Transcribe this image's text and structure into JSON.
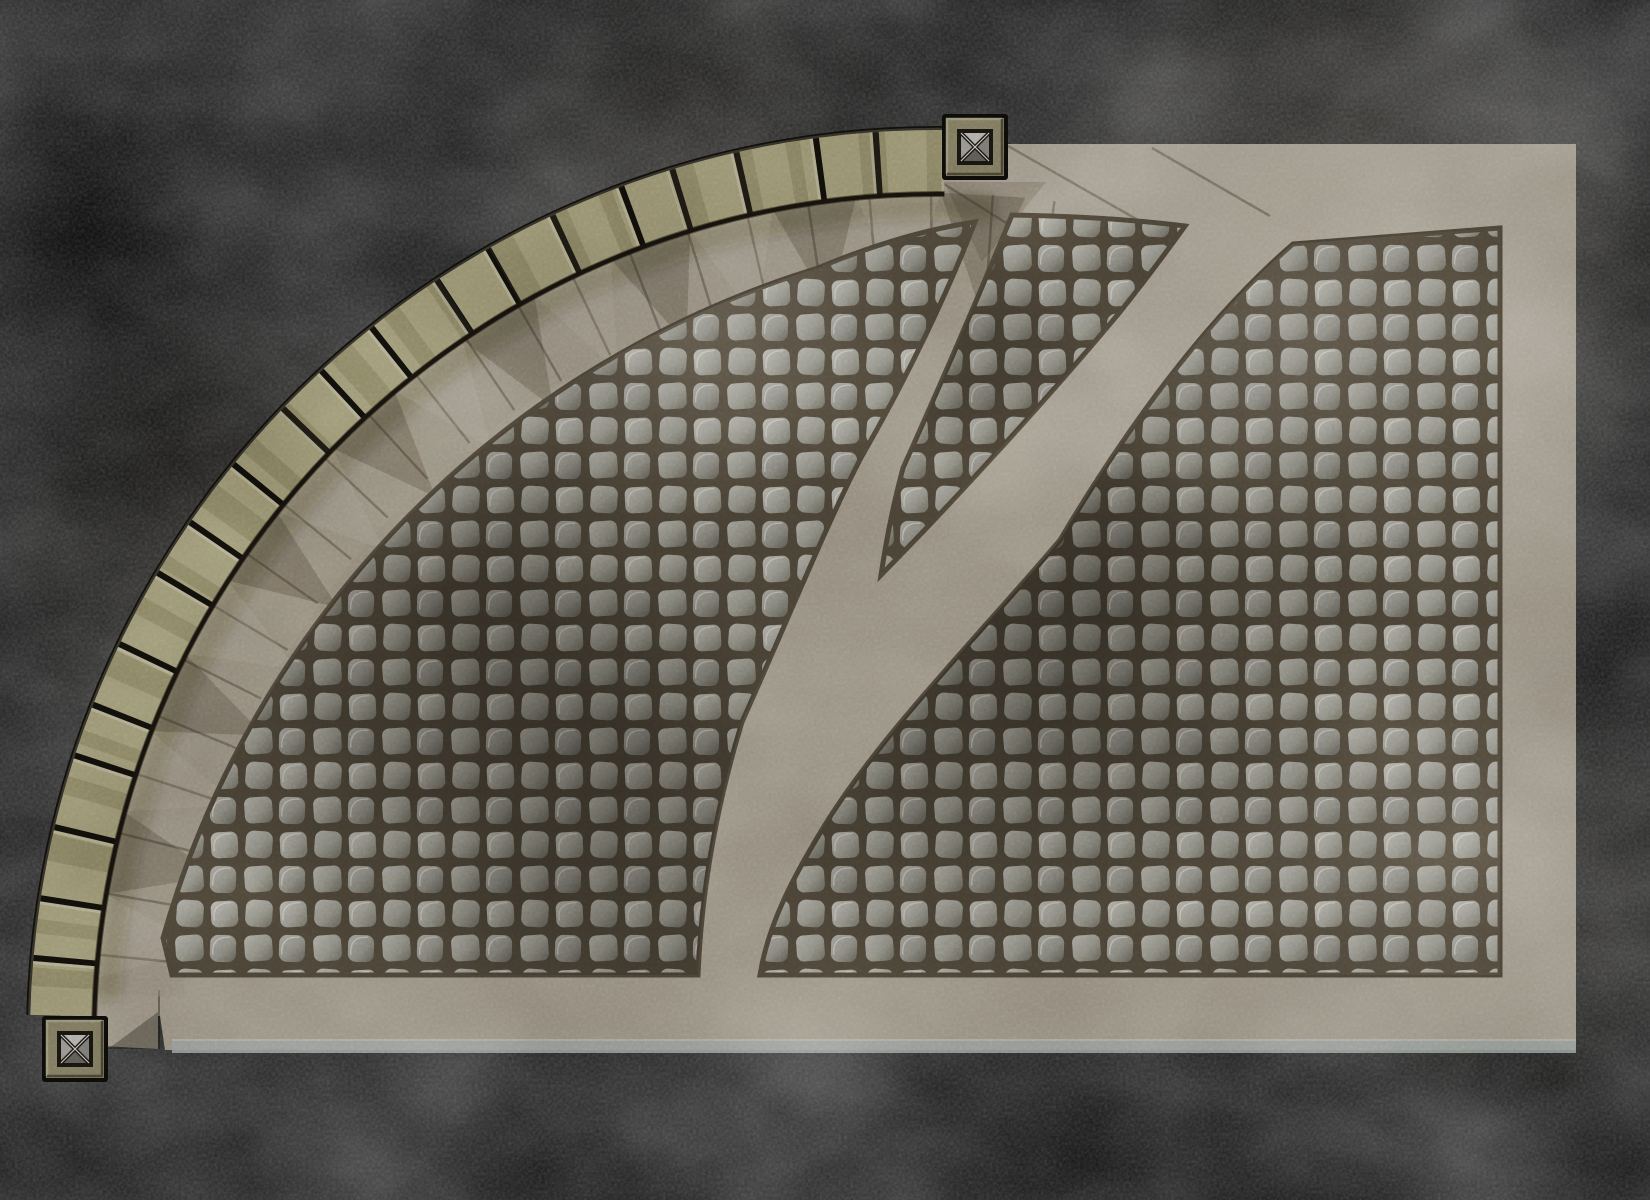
{
  "viewport": {
    "width": 1650,
    "height": 1200,
    "background": "#000000"
  },
  "palette": {
    "ground_base": "#8f8779",
    "slab_band": "#8a8274",
    "seam_line": "rgba(50,44,34,0.40)",
    "sawtooth_dark": "rgba(30,26,20,0.22)",
    "sawtooth_light": "rgba(224,218,202,0.08)",
    "cobble_gap": "#453e32",
    "stone_light": "#aeaca2",
    "stone_mid": "#8b8a81",
    "stone_dark": "#666459",
    "wall_block": "#8e8868",
    "wall_outline": "#0f0d09",
    "wall_tick": "rgba(222,216,190,0.28)",
    "wall_mottle": "rgba(66,60,40,0.22)",
    "wall_inner_shadow": "rgba(25,20,12,0.55)",
    "wall_outer_highlight": "rgba(235,230,210,0.15)",
    "wall_cast_shadow": "#1f1a12",
    "post_outline": "#0c0a07",
    "post_frame": "#6f6a54",
    "post_frame_light": "#8f8a72",
    "post_frame_dark": "#3a3628",
    "post_well": "#15120d",
    "post_face_top": "#a2a09b",
    "post_face_left": "#83817c",
    "post_face_right": "#6c6a66",
    "post_face_bottom": "#514f4b",
    "post_x_dark": "#16130e",
    "post_x_light": "#d2cfc9",
    "curb_strip": "#8d928f",
    "curb_strip_edge": "#b4b8b5"
  },
  "ground": {
    "outline": "M 945 161 A 876 876 0 0 0 61 1016 L 160 1016 L 165 1050 L 1576 1050 L 1576 144 L 945 144 Z",
    "bottom_wedge": "98,998 158,990 158,1049 102,1046",
    "bottom_wedge_shadow": "158,1012 158,1049 108,1049",
    "bottom_wedge_seam": [
      159,
      990,
      159,
      1049
    ],
    "curb": {
      "x": 172,
      "y": 1041,
      "w": 1404,
      "h": 12
    },
    "curb_edge": {
      "x": 172,
      "y": 1039,
      "w": 1404,
      "h": 2
    },
    "top_seams": [
      [
        1008,
        146,
        1152,
        228
      ],
      [
        1152,
        148,
        1270,
        216
      ],
      [
        944,
        184,
        1062,
        258
      ]
    ],
    "top_seam_triangle": "944,182 1046,182 982,262",
    "blobs": [
      {
        "cx": 1340,
        "cy": 280,
        "r": 360,
        "color": "#d8cdb8",
        "alpha": 0.22,
        "mode": "screen"
      },
      {
        "cx": 250,
        "cy": 560,
        "r": 300,
        "color": "#3a342a",
        "alpha": 0.18,
        "mode": "multiply"
      },
      {
        "cx": 700,
        "cy": 180,
        "r": 250,
        "color": "#d8cdb8",
        "alpha": 0.1,
        "mode": "screen"
      },
      {
        "cx": 1500,
        "cy": 900,
        "r": 260,
        "color": "#d8cdb8",
        "alpha": 0.1,
        "mode": "screen"
      }
    ]
  },
  "arc": {
    "center": [
      937,
      1037
    ],
    "slab_band": {
      "r": 799,
      "width": 90,
      "alpha": 0.5
    },
    "seams": {
      "rInner": 756,
      "rOuter": 844,
      "a0": -82,
      "a1": -176.5,
      "step": 4.2,
      "width": 2.5
    },
    "sawtooth": {
      "rBase": 844,
      "rApex": 737,
      "a0": -84,
      "a1": -177,
      "step": 5.75
    },
    "cast_shadow": {
      "r": 830,
      "width": 26,
      "alpha": 0.22,
      "blur": 6
    }
  },
  "wall": {
    "center": [
      937,
      1037
    ],
    "rMid": 876,
    "a0": -89.5,
    "a1": -178.6,
    "outline_width": 70,
    "block_width": 62,
    "block_dashes": [
      64,
      6,
      52,
      6,
      72,
      6,
      58,
      6,
      46,
      6,
      66,
      6
    ],
    "tick_dashes": [
      3,
      67,
      3,
      55,
      3,
      75,
      3,
      61,
      3,
      49,
      3,
      69
    ],
    "mottle_dashes": [
      18,
      40,
      26,
      57,
      14,
      33
    ],
    "inner_shadow": {
      "r": 843,
      "width": 6
    },
    "outer_highlight": {
      "r": 908,
      "width": 2.5
    }
  },
  "posts": [
    {
      "id": "corner-post-top",
      "x": 942,
      "y": 114,
      "size": 66
    },
    {
      "id": "corner-post-bottom",
      "x": 42,
      "y": 1016,
      "size": 66
    }
  ],
  "fields": {
    "stroke_width": 5,
    "left": {
      "path": "M 163 938 A 979 979 0 0 1 818 268 C 868 247 922 230 975 222 C 948 292 908 376 862 456 C 830 516 786 624 742 722 C 714 814 701 900 698 975 L 172 975 Z"
    },
    "wedge": {
      "path": "M 1012 215 C 978 298 938 390 903 468 C 893 505 886 542 881 575 C 950 505 1045 402 1120 312 C 1155 268 1175 240 1185 226 C 1130 219 1070 216 1012 215 Z"
    },
    "right": {
      "path": "M 1293 244 L 1500 228 L 1500 975 L 760 975 C 768 925 792 878 828 820 C 885 730 975 640 1060 540 C 1125 430 1205 320 1293 244 Z"
    },
    "shades": {
      "left": [
        {
          "cx": 470,
          "cy": 640,
          "r": 340,
          "color": "#2e2a23",
          "alpha": 0.42,
          "mode": "multiply"
        },
        {
          "cx": 640,
          "cy": 850,
          "r": 260,
          "color": "#2e2a23",
          "alpha": 0.3,
          "mode": "multiply"
        },
        {
          "cx": 330,
          "cy": 380,
          "r": 240,
          "color": "#efe9da",
          "alpha": 0.1,
          "mode": "screen"
        },
        {
          "cx": 700,
          "cy": 300,
          "r": 220,
          "color": "#efe9da",
          "alpha": 0.12,
          "mode": "screen"
        }
      ],
      "wedge": [
        {
          "cx": 985,
          "cy": 390,
          "r": 160,
          "color": "#2e2a23",
          "alpha": 0.25,
          "mode": "multiply"
        }
      ],
      "right": [
        {
          "cx": 1080,
          "cy": 600,
          "r": 320,
          "color": "#2e2a23",
          "alpha": 0.4,
          "mode": "multiply"
        },
        {
          "cx": 930,
          "cy": 780,
          "r": 220,
          "color": "#2e2a23",
          "alpha": 0.22,
          "mode": "multiply"
        },
        {
          "cx": 1300,
          "cy": 330,
          "r": 240,
          "color": "#efe9da",
          "alpha": 0.12,
          "mode": "screen"
        },
        {
          "cx": 1420,
          "cy": 860,
          "r": 200,
          "color": "#efe9da",
          "alpha": 0.1,
          "mode": "screen"
        }
      ]
    }
  },
  "cobbles": {
    "tile": 69,
    "stones": [
      {
        "x": 4,
        "y": 4,
        "w": 27,
        "h": 26,
        "rx": 7,
        "rot": -3,
        "grad": "gA",
        "hl": true
      },
      {
        "x": 38.5,
        "y": 3,
        "w": 27,
        "h": 27,
        "rx": 8,
        "rot": 4,
        "grad": "gB",
        "hl": false
      },
      {
        "x": 3,
        "y": 38,
        "w": 26,
        "h": 27,
        "rx": 8,
        "rot": 2,
        "grad": "gC",
        "hl": true
      },
      {
        "x": 37.5,
        "y": 38,
        "w": 28,
        "h": 26,
        "rx": 7,
        "rot": -4,
        "grad": "gB",
        "hl": false
      }
    ],
    "gradients": {
      "gA": [
        "#aeaca2",
        "#8b8a81",
        "#666459"
      ],
      "gB": [
        "#a2a098",
        "#848379",
        "#5d5b52"
      ],
      "gC": [
        "#9b9992",
        "#7d7c74",
        "#56544c"
      ]
    },
    "highlight": {
      "color": "#d8d5ca",
      "alpha": 0.5,
      "width": 1.3
    }
  },
  "noise": {
    "coarse": {
      "baseFrequency": "0.0045 0.006",
      "octaves": 4,
      "seed": 11,
      "opacity": 0.45
    },
    "fine": {
      "baseFrequency": "0.33",
      "octaves": 2,
      "seed": 5,
      "opacity": 0.2
    }
  }
}
